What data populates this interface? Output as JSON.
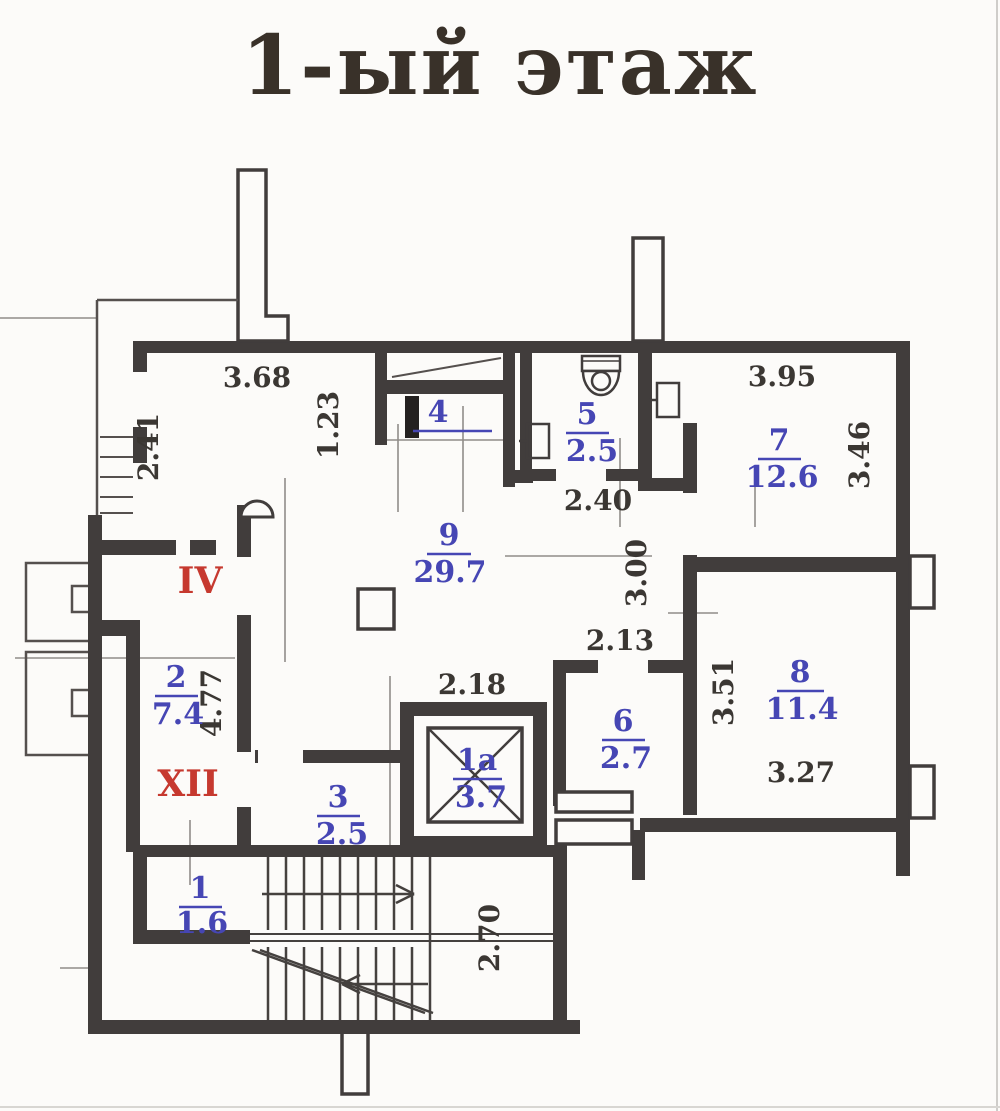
{
  "title": "1-ый этаж",
  "colors": {
    "wall": "#413d3c",
    "room_label": "#4646b4",
    "zone_label": "#c6392f",
    "dimension": "#3b3733",
    "paper": "#fcfbf9"
  },
  "rooms": {
    "r1": {
      "num": "1",
      "area": "1.6"
    },
    "r1a": {
      "num": "1а",
      "area": "3.7"
    },
    "r2": {
      "num": "2",
      "area": "7.4"
    },
    "r3": {
      "num": "3",
      "area": "2.5"
    },
    "r4": {
      "num": "4",
      "area": ""
    },
    "r5": {
      "num": "5",
      "area": "2.5"
    },
    "r6": {
      "num": "6",
      "area": "2.7"
    },
    "r7": {
      "num": "7",
      "area": "12.6"
    },
    "r8": {
      "num": "8",
      "area": "11.4"
    },
    "r9": {
      "num": "9",
      "area": "29.7"
    }
  },
  "zone_labels": {
    "vestibule": "IV",
    "corridor": "XII"
  },
  "dimensions": {
    "d368": "3.68",
    "d123": "1.23",
    "d241": "2.41",
    "d395": "3.95",
    "d346": "3.46",
    "d240": "2.40",
    "d300": "3.00",
    "d213": "2.13",
    "d477": "4.77",
    "d218": "2.18",
    "d351": "3.51",
    "d327": "3.27",
    "d270": "2.70"
  }
}
